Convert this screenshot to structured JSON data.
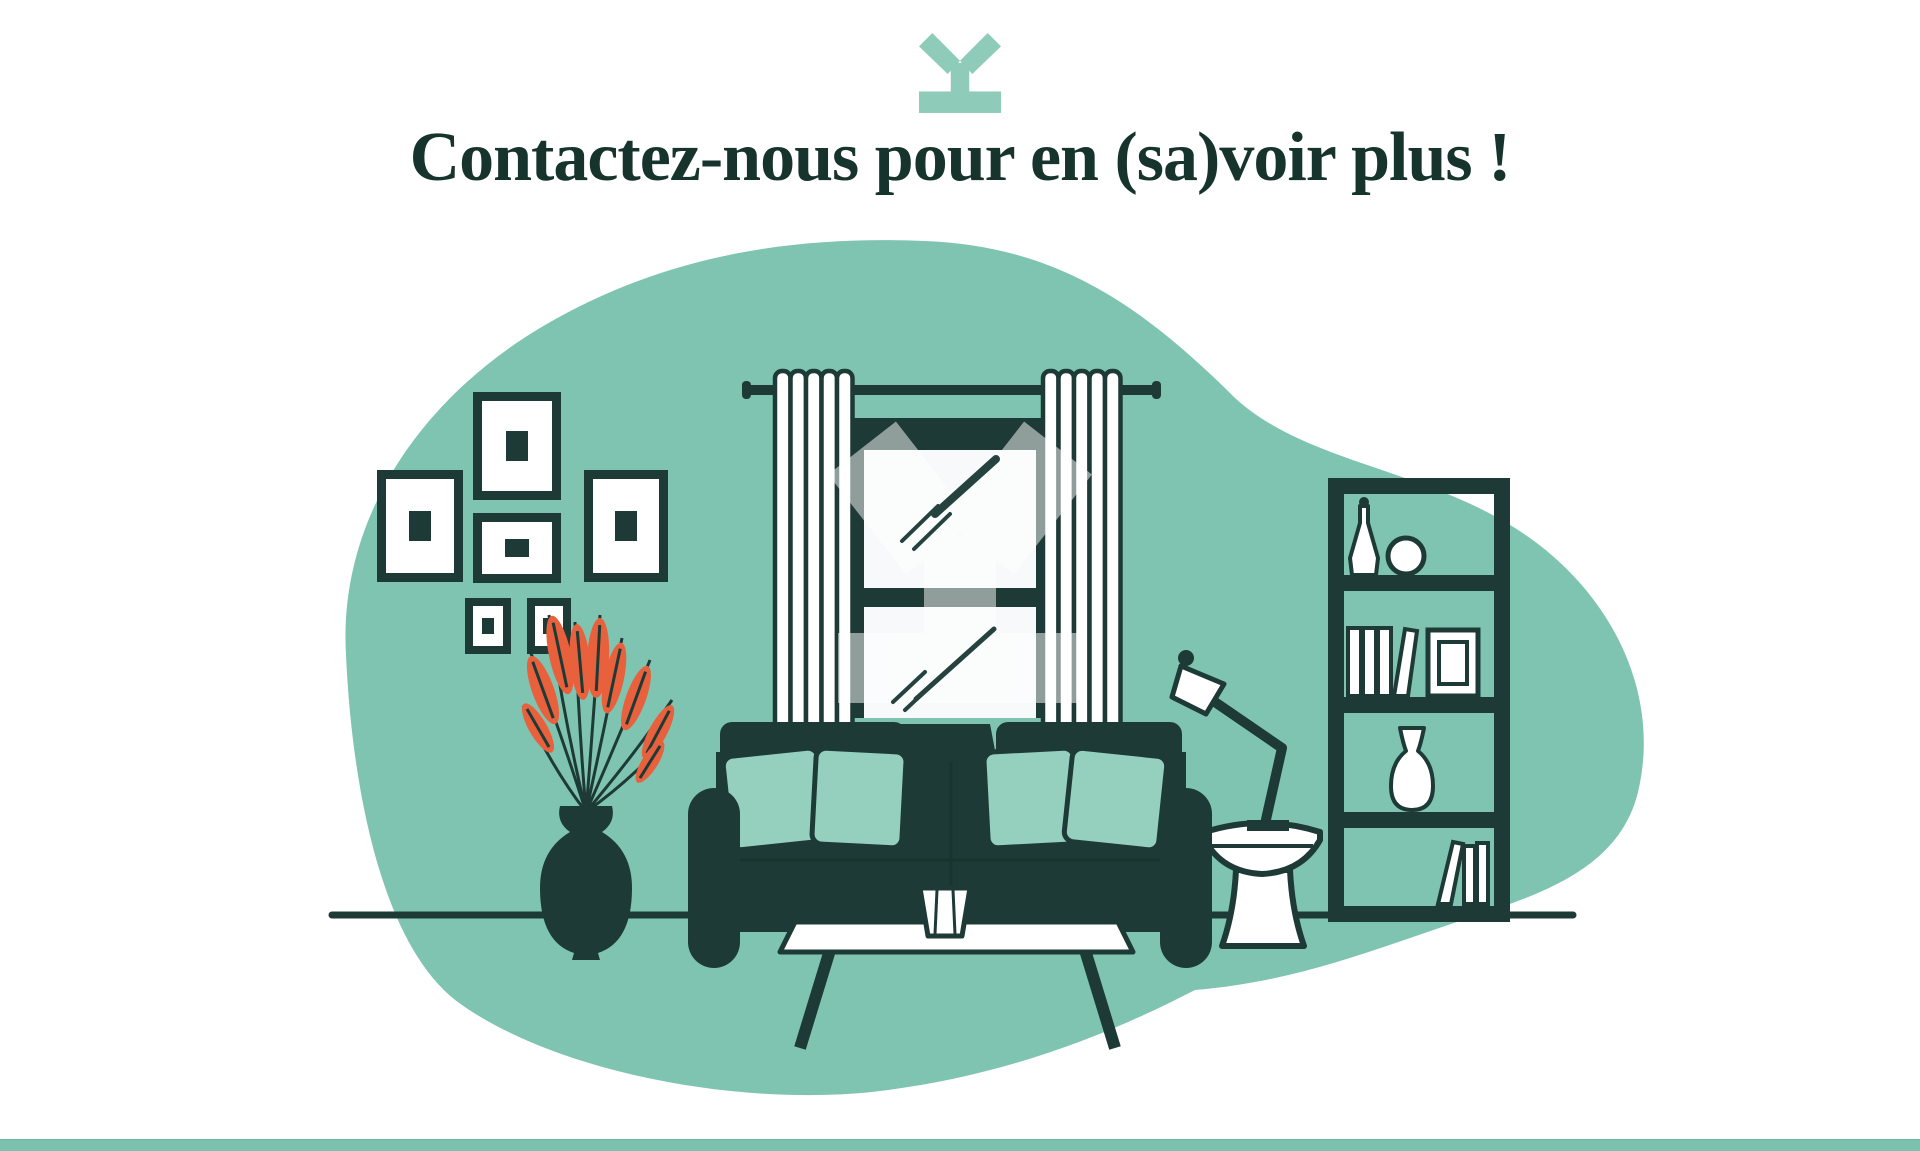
{
  "header": {
    "heading": "Contactez-nous pour en (sa)voir plus !"
  },
  "icons": {
    "logo": "y-logo-icon"
  },
  "illustration": {
    "name": "living-room-illustration",
    "elements": [
      "background-blob",
      "wall-picture-frames",
      "plant-in-vase",
      "window-with-curtains",
      "translucent-y-watermark",
      "sofa-with-pillows",
      "coffee-table-with-cup",
      "floor-lamp",
      "side-table",
      "bookshelf",
      "floor-line"
    ]
  },
  "colors": {
    "heading": "#17342C",
    "dark": "#1E3A36",
    "dark-line": "#25423E",
    "teal": "#7EC4B1",
    "teal-light": "#95CFBE",
    "orange": "#E8613C",
    "logo-teal": "#8FCBB9",
    "pane": "#F7F9FA",
    "bar": "#7CC0AE",
    "bar-edge": "#6FB3A1",
    "white": "#FFFFFF"
  }
}
